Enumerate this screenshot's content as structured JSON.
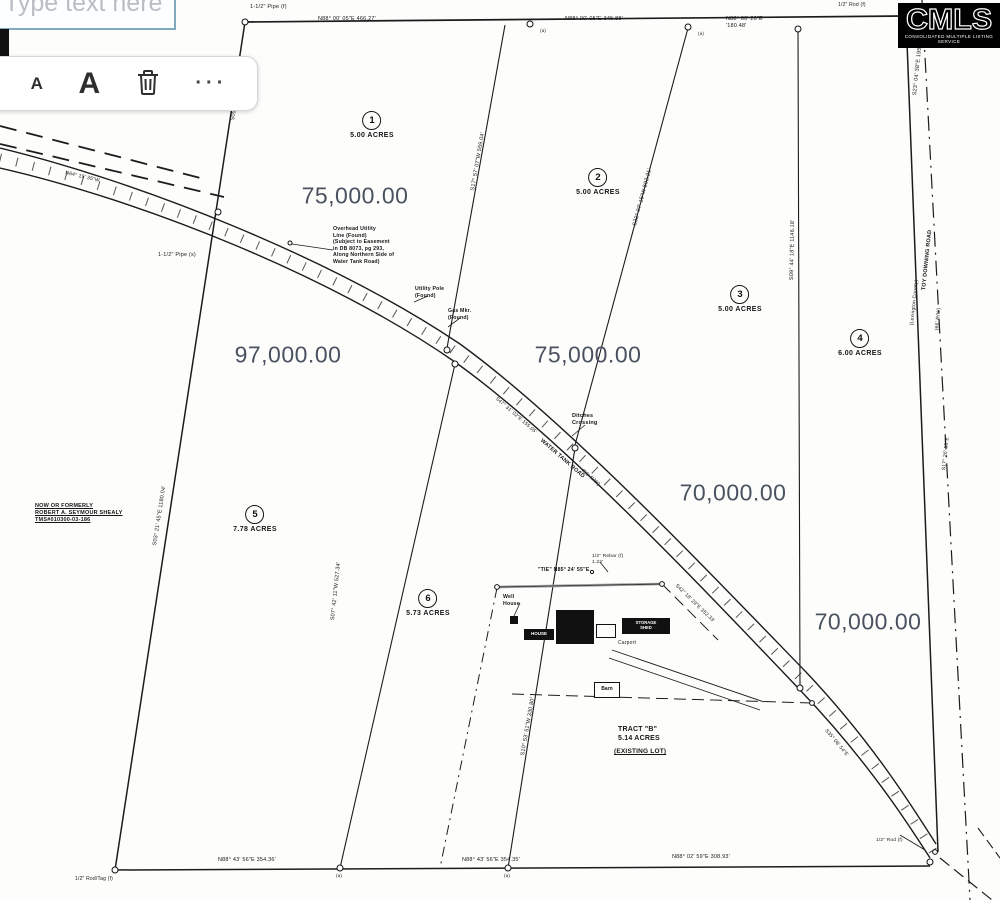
{
  "annotation_tool": {
    "text_input": {
      "placeholder": "Type text here"
    },
    "toolbar": {
      "decrease_font_label": "A",
      "increase_font_label": "A",
      "delete_icon": "trash-icon",
      "more_icon": "ellipsis-icon",
      "more_glyph": "···"
    }
  },
  "logo": {
    "name": "CMLS",
    "tagline": "CONSOLIDATED MULTIPLE LISTING SERVICE"
  },
  "map": {
    "lots": [
      {
        "n": "1",
        "acres": "5.00 ACRES",
        "x": 372,
        "y": 120
      },
      {
        "n": "2",
        "acres": "5.00 ACRES",
        "x": 598,
        "y": 177
      },
      {
        "n": "3",
        "acres": "5.00 ACRES",
        "x": 740,
        "y": 294
      },
      {
        "n": "4",
        "acres": "6.00 ACRES",
        "x": 860,
        "y": 338
      },
      {
        "n": "5",
        "acres": "7.78 ACRES",
        "x": 255,
        "y": 514
      },
      {
        "n": "6",
        "acres": "5.73 ACRES",
        "x": 428,
        "y": 598
      }
    ],
    "prices": [
      {
        "v": "75,000.00",
        "x": 355,
        "y": 196
      },
      {
        "v": "97,000.00",
        "x": 288,
        "y": 355
      },
      {
        "v": "75,000.00",
        "x": 588,
        "y": 355
      },
      {
        "v": "70,000.00",
        "x": 733,
        "y": 493
      },
      {
        "v": "70,000.00",
        "x": 868,
        "y": 622
      }
    ],
    "tract": {
      "name": "TRACT \"B\"",
      "acres": "5.14 ACRES",
      "note": "(EXISTING LOT)"
    },
    "structures": [
      {
        "x": 510,
        "y": 616,
        "w": 8,
        "h": 8,
        "kind": "solid"
      },
      {
        "x": 556,
        "y": 610,
        "w": 38,
        "h": 34,
        "kind": "solid"
      },
      {
        "x": 524,
        "y": 629,
        "w": 30,
        "h": 11,
        "kind": "solid",
        "label": "HOUSE",
        "ls": 4.5
      },
      {
        "x": 596,
        "y": 624,
        "w": 20,
        "h": 14,
        "kind": "outline"
      },
      {
        "x": 622,
        "y": 618,
        "w": 48,
        "h": 16,
        "kind": "solid",
        "label": "STORAGE\nSHED",
        "ls": 4.2
      },
      {
        "x": 594,
        "y": 682,
        "w": 26,
        "h": 16,
        "kind": "outline",
        "label": "Barn",
        "ls": 5
      }
    ],
    "labels": [
      {
        "t": "1-1/2\" Pipe (f)",
        "x": 250,
        "y": 4,
        "s": 5.5
      },
      {
        "t": "N88° 00' 05\"E      466.27'",
        "x": 318,
        "y": 16,
        "s": 5.5
      },
      {
        "t": "N88° 00' 05\"E   345.88'",
        "x": 565,
        "y": 16,
        "s": 5.5
      },
      {
        "t": "N88° 00' 26\"E\n'180.48'",
        "x": 726,
        "y": 16,
        "s": 5.5
      },
      {
        "t": "1/2\" Rod (f)",
        "x": 838,
        "y": 2,
        "s": 5
      },
      {
        "t": "(a)",
        "x": 540,
        "y": 28,
        "s": 4.5
      },
      {
        "t": "(a)",
        "x": 698,
        "y": 31,
        "s": 4.5
      },
      {
        "t": "S23° 04' 38\"E  195.87'",
        "x": 912,
        "y": 95,
        "r": -84,
        "s": 5.5
      },
      {
        "t": "S05° 36' 04\"E  557.85'",
        "x": 230,
        "y": 120,
        "r": -81,
        "s": 5.5
      },
      {
        "t": "N64° 19' 35\"W",
        "x": 66,
        "y": 170,
        "r": 13,
        "s": 5
      },
      {
        "t": "1-1/2\" Pipe (s)",
        "x": 158,
        "y": 252,
        "s": 5.5
      },
      {
        "t": "S03° 21' 45\"E  1180.04'",
        "x": 152,
        "y": 545,
        "r": -81,
        "s": 5.5
      },
      {
        "t": "S17° 57' 07\"W  559.04'",
        "x": 470,
        "y": 190,
        "r": -80,
        "s": 5.5
      },
      {
        "t": "S32° 07' 15\"W  502.21'",
        "x": 632,
        "y": 225,
        "r": -75,
        "s": 5.5
      },
      {
        "t": "S09° 44' 18\"E  1146.18'",
        "x": 789,
        "y": 280,
        "r": -89,
        "s": 5.5
      },
      {
        "t": "Overhead Utility\nLine (Found)\n(Subject to Easement\nin DB 8073, pg 293,\nAlong Northern Side of\nWater Tank Road)",
        "x": 333,
        "y": 226,
        "s": 5.2,
        "w": 700
      },
      {
        "t": "Utility Pole\n(Found)",
        "x": 415,
        "y": 286,
        "s": 5.2,
        "w": 700
      },
      {
        "t": "Gas Mkr.\n(Found)",
        "x": 448,
        "y": 308,
        "s": 5.2,
        "w": 700
      },
      {
        "t": "Ditches\nCrossing",
        "x": 572,
        "y": 413,
        "s": 5.5,
        "w": 700
      },
      {
        "t": "S47° 31' 02\"E  155.05'",
        "x": 498,
        "y": 396,
        "r": 41,
        "s": 5
      },
      {
        "t": "WATER TANK ROAD",
        "x": 543,
        "y": 438,
        "r": 41,
        "s": 5.5,
        "w": 700
      },
      {
        "t": "(66' R/W)",
        "x": 584,
        "y": 468,
        "r": 41,
        "s": 5
      },
      {
        "t": "S42° 18' 29\"E  352.33'",
        "x": 678,
        "y": 583,
        "r": 44,
        "s": 5
      },
      {
        "t": "S35° 08' 54\"E",
        "x": 828,
        "y": 728,
        "r": 50,
        "s": 5
      },
      {
        "t": "NOW OR FORMERLY\nROBERT A. SEYMOUR SHEALY\nTMS#010300-03-186",
        "x": 35,
        "y": 503,
        "s": 5.5,
        "w": 700,
        "u": 1
      },
      {
        "t": "\"TIE\"  N85° 24' 55\"E",
        "x": 538,
        "y": 567,
        "s": 5.2,
        "w": 700
      },
      {
        "t": "1/2\" Rebar (f)\n1.22'",
        "x": 592,
        "y": 554,
        "s": 4.8
      },
      {
        "t": "Well\nHouse",
        "x": 503,
        "y": 594,
        "s": 5.2,
        "w": 700
      },
      {
        "t": "Carport",
        "x": 618,
        "y": 640,
        "s": 5
      },
      {
        "t": "S07° 42' 11\"W  527.34'",
        "x": 330,
        "y": 620,
        "r": -84,
        "s": 5.5
      },
      {
        "t": "S10° 53' 51\"W  330.80'",
        "x": 520,
        "y": 755,
        "r": -80,
        "s": 5.5
      },
      {
        "t": "TRACT \"B\"\n5.14 ACRES",
        "x": 618,
        "y": 726,
        "s": 7,
        "w": 700
      },
      {
        "t": "(EXISTING LOT)",
        "x": 614,
        "y": 748,
        "s": 6.5,
        "w": 700,
        "u": 1
      },
      {
        "t": "N88° 43' 56\"E      354.36'",
        "x": 218,
        "y": 857,
        "s": 5.5
      },
      {
        "t": "N88° 43' 56\"E   354.35'",
        "x": 462,
        "y": 857,
        "s": 5.5
      },
      {
        "t": "N88° 02' 59\"E   308.93'",
        "x": 672,
        "y": 854,
        "s": 5.5
      },
      {
        "t": "(a)",
        "x": 336,
        "y": 873,
        "s": 4.5
      },
      {
        "t": "(a)",
        "x": 504,
        "y": 873,
        "s": 4.5
      },
      {
        "t": "1/2\" Rod/Tag (f)",
        "x": 75,
        "y": 876,
        "s": 5
      },
      {
        "t": "TOY DOWNING ROAD",
        "x": 921,
        "y": 290,
        "r": -84,
        "s": 5.5,
        "w": 700
      },
      {
        "t": "(66' R/W)",
        "x": 934,
        "y": 330,
        "r": -84,
        "s": 5
      },
      {
        "t": "(Lexington County)",
        "x": 909,
        "y": 325,
        "r": -84,
        "s": 5
      },
      {
        "t": "S17° 26' 05\"E",
        "x": 941,
        "y": 470,
        "r": -84,
        "s": 5
      },
      {
        "t": "1/2\" Rod (f)",
        "x": 876,
        "y": 838,
        "s": 4.8
      }
    ]
  }
}
